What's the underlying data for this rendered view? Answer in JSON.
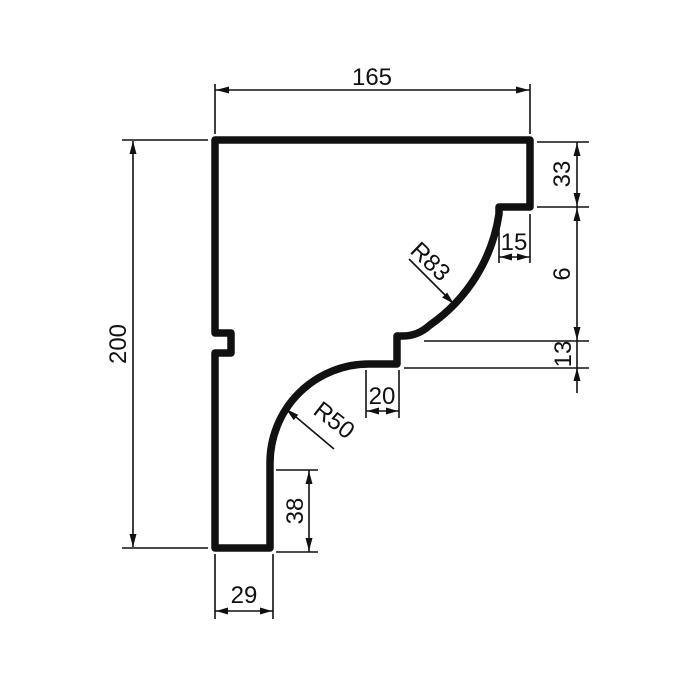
{
  "drawing": {
    "kind": "profile-cross-section",
    "colors": {
      "ink": "#111111",
      "background": "#ffffff"
    }
  },
  "labels": {
    "width": "165",
    "height": "200",
    "top_right": "33",
    "step": "15",
    "mid_right": "6",
    "ledge": "13",
    "run": "20",
    "leg": "38",
    "base": "29",
    "radius_upper": "R83",
    "radius_lower": "R50"
  }
}
